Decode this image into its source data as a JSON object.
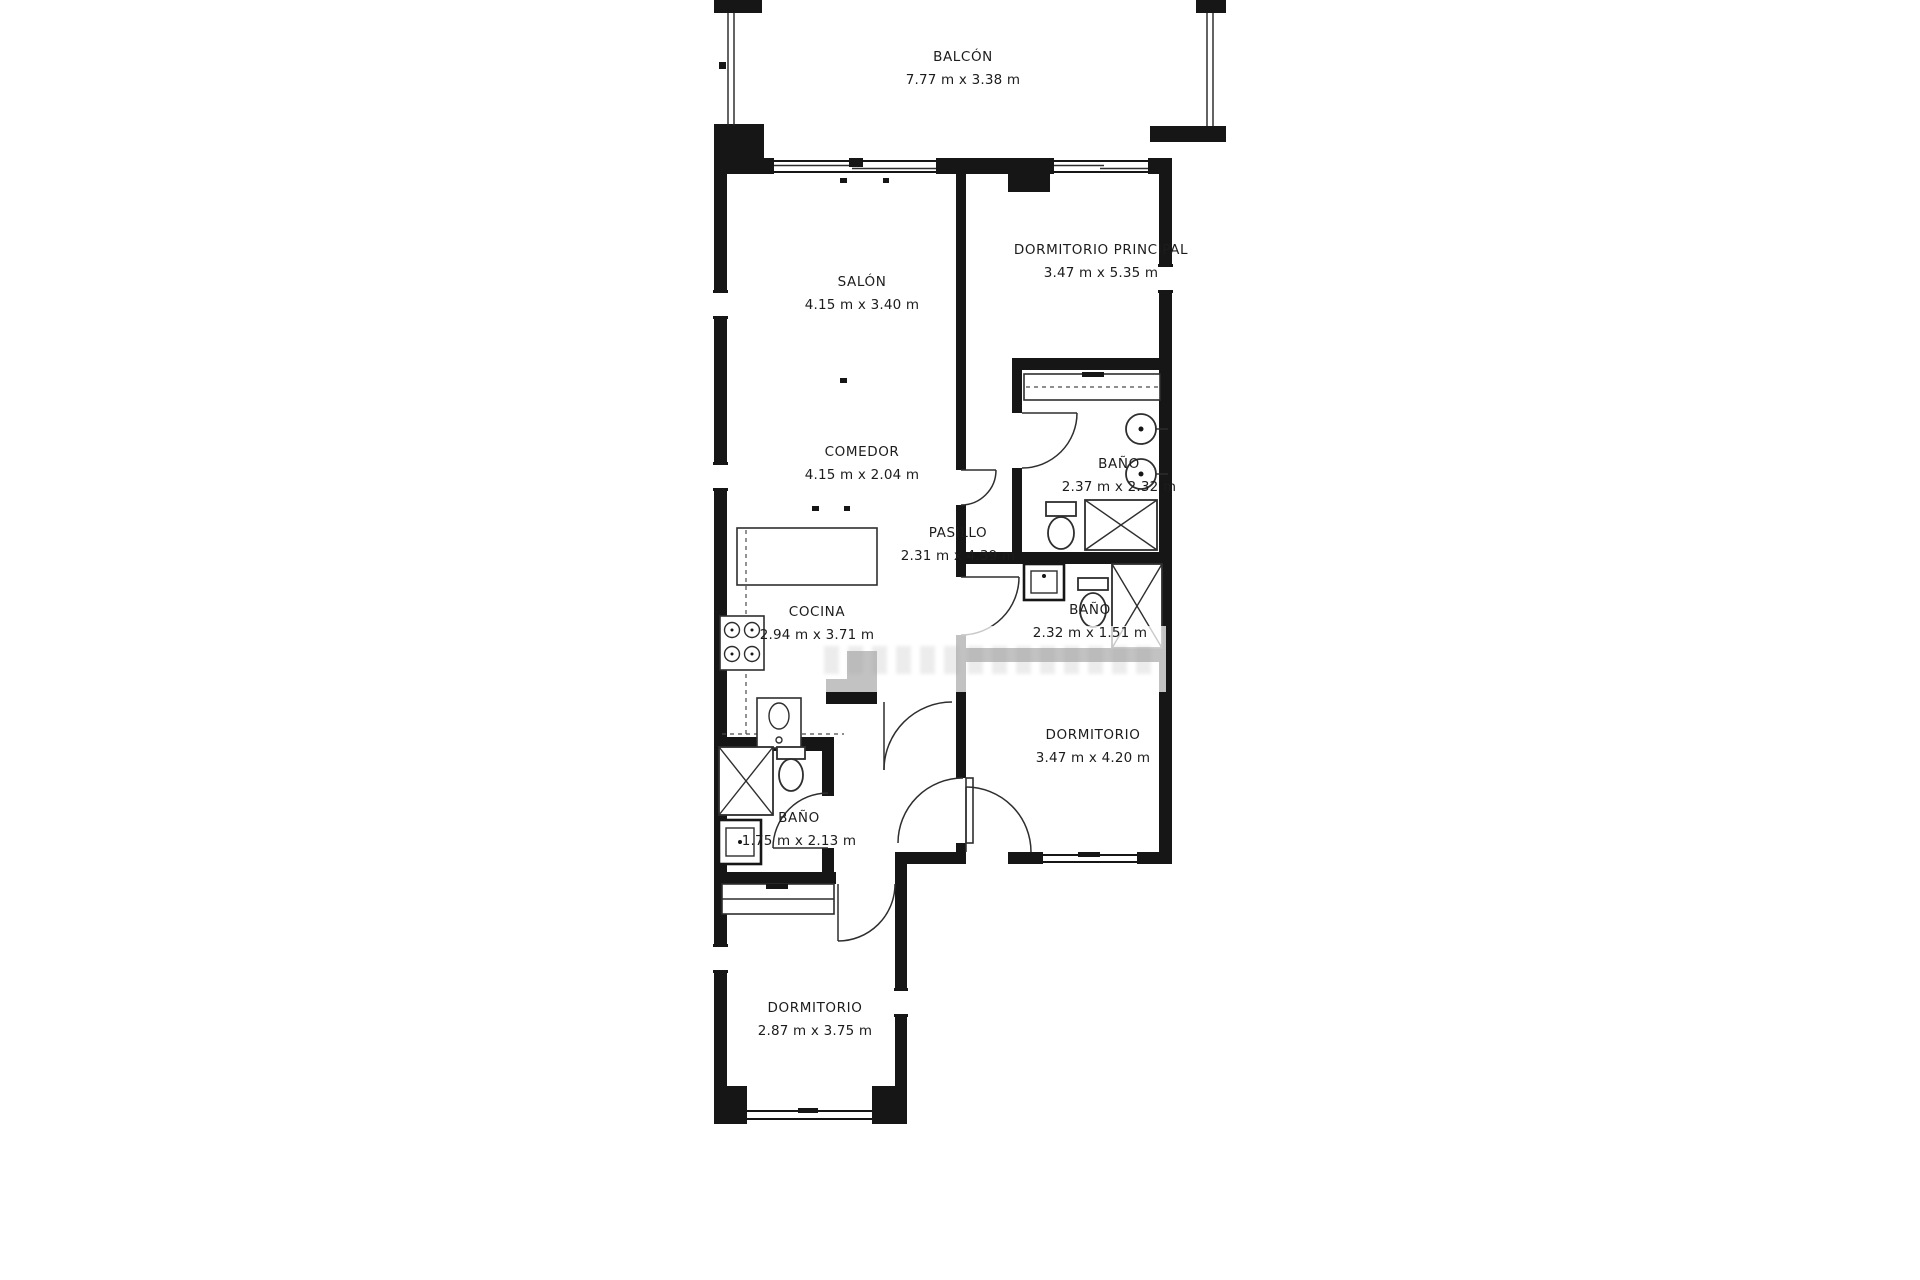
{
  "colors": {
    "background": "#ffffff",
    "wall": "#161616",
    "line": "#2e2e2e",
    "label_text": "#1c1c1c"
  },
  "rooms": [
    {
      "id": "balcon",
      "name": "BALCÓN",
      "dims": "7.77 m x 3.38 m"
    },
    {
      "id": "salon",
      "name": "SALÓN",
      "dims": "4.15 m x 3.40 m"
    },
    {
      "id": "dormitorio-principal",
      "name": "DORMITORIO PRINCIPAL",
      "dims": "3.47 m x 5.35 m"
    },
    {
      "id": "comedor",
      "name": "COMEDOR",
      "dims": "4.15 m x 2.04 m"
    },
    {
      "id": "bano-principal",
      "name": "BAÑO",
      "dims": "2.37 m x 2.32 m"
    },
    {
      "id": "pasillo",
      "name": "PASILLO",
      "dims": "2.31 m x 4.39 m"
    },
    {
      "id": "cocina",
      "name": "COCINA",
      "dims": "2.94 m x 3.71 m"
    },
    {
      "id": "bano-2",
      "name": "BAÑO",
      "dims": "2.32 m x 1.51 m"
    },
    {
      "id": "dormitorio-2",
      "name": "DORMITORIO",
      "dims": "3.47 m x 4.20 m"
    },
    {
      "id": "bano-3",
      "name": "BAÑO",
      "dims": "1.75 m x 2.13 m"
    },
    {
      "id": "dormitorio-3",
      "name": "DORMITORIO",
      "dims": "2.87 m x 3.75 m"
    }
  ]
}
